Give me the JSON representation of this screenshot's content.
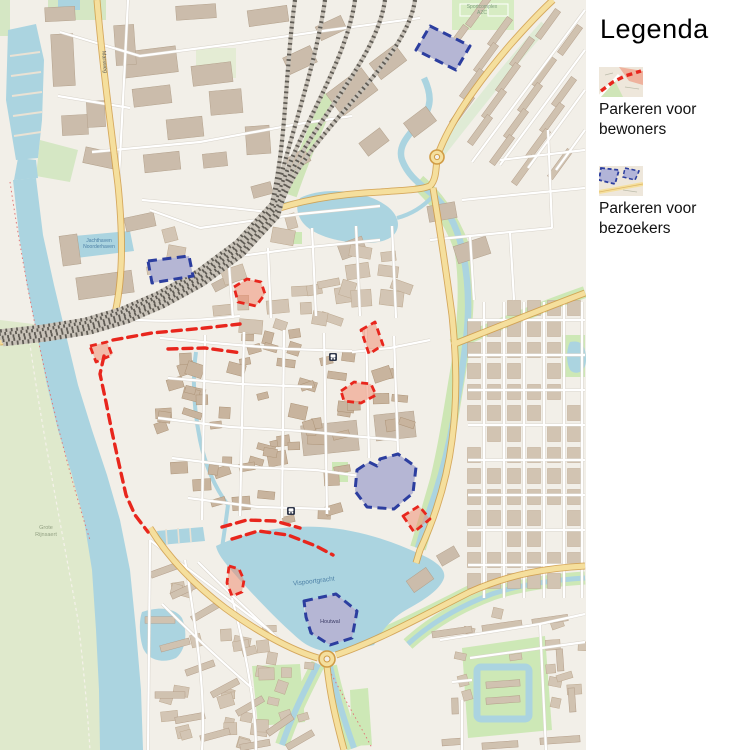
{
  "app": {
    "type": "city-parking-map"
  },
  "legend": {
    "title": "Legenda",
    "items": [
      {
        "id": "resident",
        "label_line1": "Parkeren voor",
        "label_line2": "bewoners",
        "color": "#e8261d"
      },
      {
        "id": "visitor",
        "label_line1": "Parkeren voor",
        "label_line2": "bezoekers",
        "color": "#2c3e9f"
      }
    ]
  },
  "map": {
    "colors": {
      "water": "#abd4e0",
      "park_green": "#cde8b6",
      "floodplain_green": "#dfe9cc",
      "land": "#f2efe8",
      "building": "#d4c6b4",
      "old_town_building": "#c8b49e",
      "major_road": "#f5df9d",
      "railway": "#5f5b54",
      "resident_parking": "#e8261d",
      "resident_parking_fill": "rgba(240,135,105,0.5)",
      "visitor_parking": "#2c3e9f",
      "visitor_parking_fill": "rgba(167,170,215,0.72)"
    },
    "labels": [
      {
        "text": "Jachthaven",
        "x": 99,
        "y": 242,
        "size": 5,
        "color": "#4d80a6",
        "rot": 0
      },
      {
        "text": "Noorderhaven",
        "x": 99,
        "y": 248,
        "size": 5,
        "color": "#4d80a6",
        "rot": 0
      },
      {
        "text": "Vispoortgracht",
        "x": 314,
        "y": 583,
        "size": 6.5,
        "color": "#4d80a6",
        "rot": -7
      },
      {
        "text": "Houtwal",
        "x": 330,
        "y": 623,
        "size": 5.5,
        "color": "#3c3c66",
        "rot": 0
      },
      {
        "text": "Grote",
        "x": 46,
        "y": 529,
        "size": 5.5,
        "color": "#93a183",
        "rot": 0
      },
      {
        "text": "Rijnsaert",
        "x": 46,
        "y": 536,
        "size": 5.5,
        "color": "#93a183",
        "rot": 0
      },
      {
        "text": "Sportcomplex",
        "x": 482,
        "y": 8,
        "size": 5,
        "color": "#7f9f7f",
        "rot": 0
      },
      {
        "text": "AZC",
        "x": 482,
        "y": 14,
        "size": 5,
        "color": "#7f9f7f",
        "rot": 0
      },
      {
        "text": "Marsweg",
        "x": 103,
        "y": 62,
        "size": 5.5,
        "color": "#5a5a5a",
        "rot": 86
      }
    ],
    "icons": [
      {
        "name": "train-station-icon",
        "x": 333,
        "y": 357
      },
      {
        "name": "train-station-icon",
        "x": 291,
        "y": 511
      }
    ],
    "overlays": {
      "resident_parking": {
        "legend": "Parkeren voor bewoners",
        "stroke": "#e8261d",
        "fill": "rgba(240,135,105,0.5)",
        "boundary_lines": [
          [
            [
              113,
              340
            ],
            [
              152,
              333
            ],
            [
              205,
              328
            ],
            [
              240,
              324
            ]
          ],
          [
            [
              168,
              349
            ],
            [
              205,
              348
            ],
            [
              242,
              353
            ]
          ],
          [
            [
              104,
              356
            ],
            [
              100,
              374
            ],
            [
              106,
              402
            ],
            [
              112,
              432
            ],
            [
              119,
              464
            ],
            [
              126,
              495
            ],
            [
              135,
              515
            ],
            [
              148,
              532
            ]
          ],
          [
            [
              222,
              527
            ],
            [
              247,
              520
            ],
            [
              275,
              521
            ],
            [
              300,
              528
            ]
          ],
          [
            [
              232,
              539
            ],
            [
              258,
              531
            ],
            [
              288,
              535
            ],
            [
              316,
              546
            ],
            [
              333,
              555
            ]
          ]
        ],
        "areas": [
          [
            [
              234,
              287
            ],
            [
              247,
              279
            ],
            [
              261,
              282
            ],
            [
              265,
              294
            ],
            [
              256,
              306
            ],
            [
              238,
              302
            ]
          ],
          [
            [
              90,
              346
            ],
            [
              107,
              342
            ],
            [
              112,
              355
            ],
            [
              96,
              362
            ]
          ],
          [
            [
              361,
              330
            ],
            [
              375,
              322
            ],
            [
              383,
              345
            ],
            [
              369,
              354
            ]
          ],
          [
            [
              341,
              391
            ],
            [
              354,
              382
            ],
            [
              371,
              384
            ],
            [
              376,
              395
            ],
            [
              361,
              403
            ],
            [
              344,
              401
            ]
          ],
          [
            [
              403,
              516
            ],
            [
              419,
              506
            ],
            [
              430,
              519
            ],
            [
              414,
              532
            ]
          ],
          [
            [
              229,
              566
            ],
            [
              239,
              569
            ],
            [
              244,
              580
            ],
            [
              242,
              592
            ],
            [
              232,
              596
            ],
            [
              227,
              583
            ]
          ]
        ]
      },
      "visitor_parking": {
        "legend": "Parkeren voor bezoekers",
        "stroke": "#2c3e9f",
        "fill": "rgba(167,170,215,0.72)",
        "areas": [
          [
            [
              430,
              26
            ],
            [
              470,
              46
            ],
            [
              456,
              70
            ],
            [
              416,
              50
            ]
          ],
          [
            [
              148,
              261
            ],
            [
              189,
              256
            ],
            [
              193,
              276
            ],
            [
              152,
              283
            ]
          ],
          [
            [
              357,
              470
            ],
            [
              369,
              462
            ],
            [
              377,
              466
            ],
            [
              380,
              459
            ],
            [
              398,
              454
            ],
            [
              416,
              467
            ],
            [
              413,
              493
            ],
            [
              394,
              509
            ],
            [
              367,
              507
            ],
            [
              355,
              491
            ]
          ],
          [
            [
              304,
              601
            ],
            [
              336,
              594
            ],
            [
              357,
              611
            ],
            [
              352,
              638
            ],
            [
              330,
              645
            ],
            [
              311,
              633
            ],
            [
              306,
              617
            ]
          ]
        ]
      }
    }
  }
}
